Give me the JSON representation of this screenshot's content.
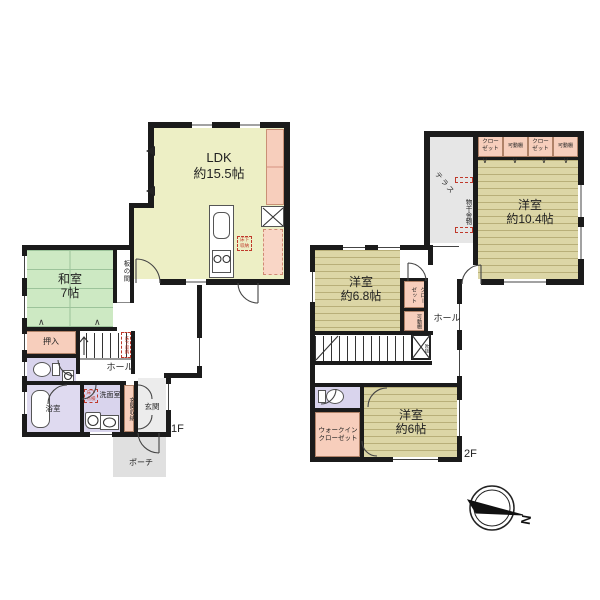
{
  "colors": {
    "wall": "#1b1b1b",
    "ldk_fill": "#edefc5",
    "tatami_fill": "#cde9c3",
    "wood_fill": "#dcd6a6",
    "closet_pink": "#f7cebc",
    "sanitary_lavender": "#d9d4ed",
    "terrace_grey": "#e6e6e6",
    "annotation_red": "#c0392b"
  },
  "floor1": {
    "floor_label": "1F",
    "ldk_label": "LDK\n約15.5帖",
    "washitsu_label": "和室\n7帖",
    "itanoma_label": "板の間",
    "oshiire_label": "押入",
    "hall_label": "ホール",
    "stair_annotation": "床下収納",
    "bath_label": "浴室",
    "washroom_label": "洗面室",
    "washroom_annotation": "床下\n点検",
    "kitchen_annotation": "床下\n収納",
    "entrance_storage_label": "玄関収納",
    "entrance_label": "玄関",
    "porch_label": "ポーチ"
  },
  "floor2": {
    "floor_label": "2F",
    "bedroom_large_label": "洋室\n約10.4帖",
    "bedroom_mid_label": "洋室\n約6.8帖",
    "bedroom_small_label": "洋室\n約6帖",
    "terrace_label": "テラス",
    "laundry_hardware_label": "物干金物",
    "closet_label_1": "クロー\nゼット",
    "shelf_label_1": "可動棚",
    "closet_label_2": "クロー\nゼット",
    "shelf_label_2": "可動棚",
    "closet_label_3": "クロー\nゼット",
    "shelf_label_3": "可動棚",
    "hall_label": "ホール",
    "void_label": "吹抜",
    "wic_label": "ウォークイン\nクローゼット"
  },
  "compass": {
    "north_label": "N"
  }
}
